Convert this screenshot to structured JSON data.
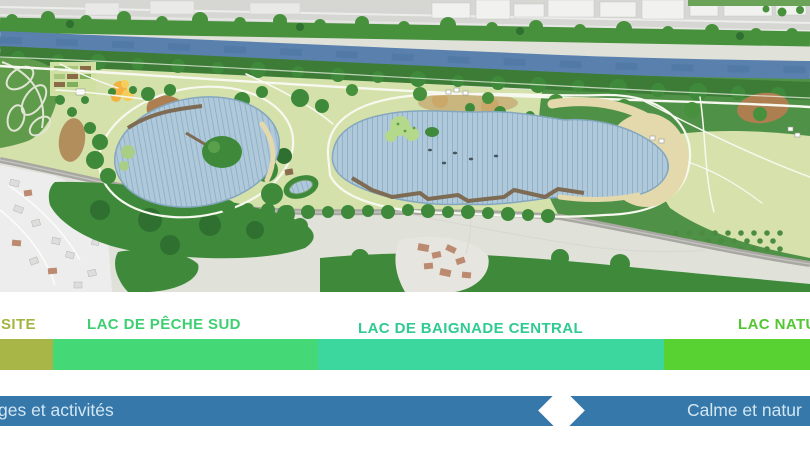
{
  "legend": {
    "zones": [
      {
        "label": "SITE",
        "text_color": "#a3b440",
        "bar_color": "#a7b647"
      },
      {
        "label": "LAC DE PÊCHE SUD",
        "text_color": "#3ecf72",
        "bar_color": "#45d876"
      },
      {
        "label": "LAC DE BAIGNADE CENTRAL",
        "text_color": "#2fcb92",
        "bar_color": "#3bd79e"
      },
      {
        "label": "LAC NATU",
        "text_color": "#52c731",
        "bar_color": "#58d133"
      }
    ]
  },
  "timeline": {
    "left_label": "ges et activités",
    "right_label": "Calme et natur",
    "bar_color": "#3578a9",
    "text_color": "#d2e6f3",
    "diamond_color": "#ffffff"
  },
  "map_palette": {
    "urban-grey": "#d6d7d3",
    "building-white": "#f1f2f0",
    "river-blue": "#5a81ae",
    "tree-dark": "#3e8a3a",
    "tree-mid": "#47903c",
    "woodland": "#4f9146",
    "park-green": "#d4e1aa",
    "field-pale": "#e0e2da",
    "road-grey": "#a8a7a2",
    "lake-fill": "#b0c9da",
    "lake-hatch": "#8fb2c8",
    "lake-edge": "#84a7bf",
    "sand": "#e3d9ac",
    "boardwalk-brown": "#7e6b54",
    "garden-green": "#5f9b4a",
    "path-white": "#f7f8ef",
    "playground-orange": "#f3b13f",
    "playground-yellow": "#f6cd5a"
  }
}
